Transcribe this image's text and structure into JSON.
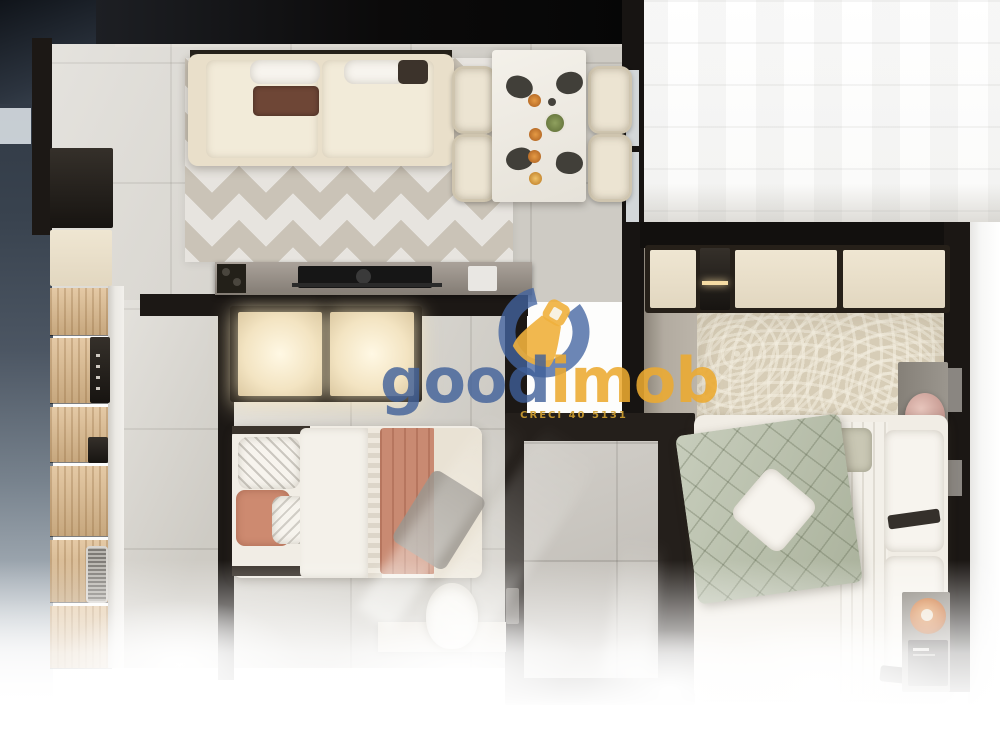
{
  "watermark": {
    "brand_first": "good",
    "brand_second": "imob",
    "tagline": "CRECI 40 5131",
    "icon": "key-ring-logo",
    "colors": {
      "blue": "#3e5f99",
      "yellow": "#ecaa30"
    }
  },
  "palette": {
    "wall": "#1c1815",
    "tile_floor": "#d9d6cf",
    "chevron_rug": "#cac3b7",
    "curved_rug": "#d7cdb7",
    "kitchen_wood": "#ddba8c",
    "sofa_beige": "#e9dfca",
    "terracotta": "#c98a72",
    "sage_green": "#b4bca5",
    "exterior_shadow": "#39434f"
  },
  "scene": {
    "type": "apartment-floor-plan-3d-render",
    "rooms": [
      "living-dining",
      "kitchen",
      "bedroom-1",
      "bathroom",
      "bedroom-2"
    ],
    "furniture": [
      "sofa",
      "dining-table",
      "dining-chairs",
      "tv-console",
      "kitchen-cabinets",
      "sink",
      "oven",
      "wardrobe",
      "double-bed-terracotta",
      "desk-chair",
      "double-bed-green",
      "nightstand",
      "table-lamp"
    ]
  }
}
